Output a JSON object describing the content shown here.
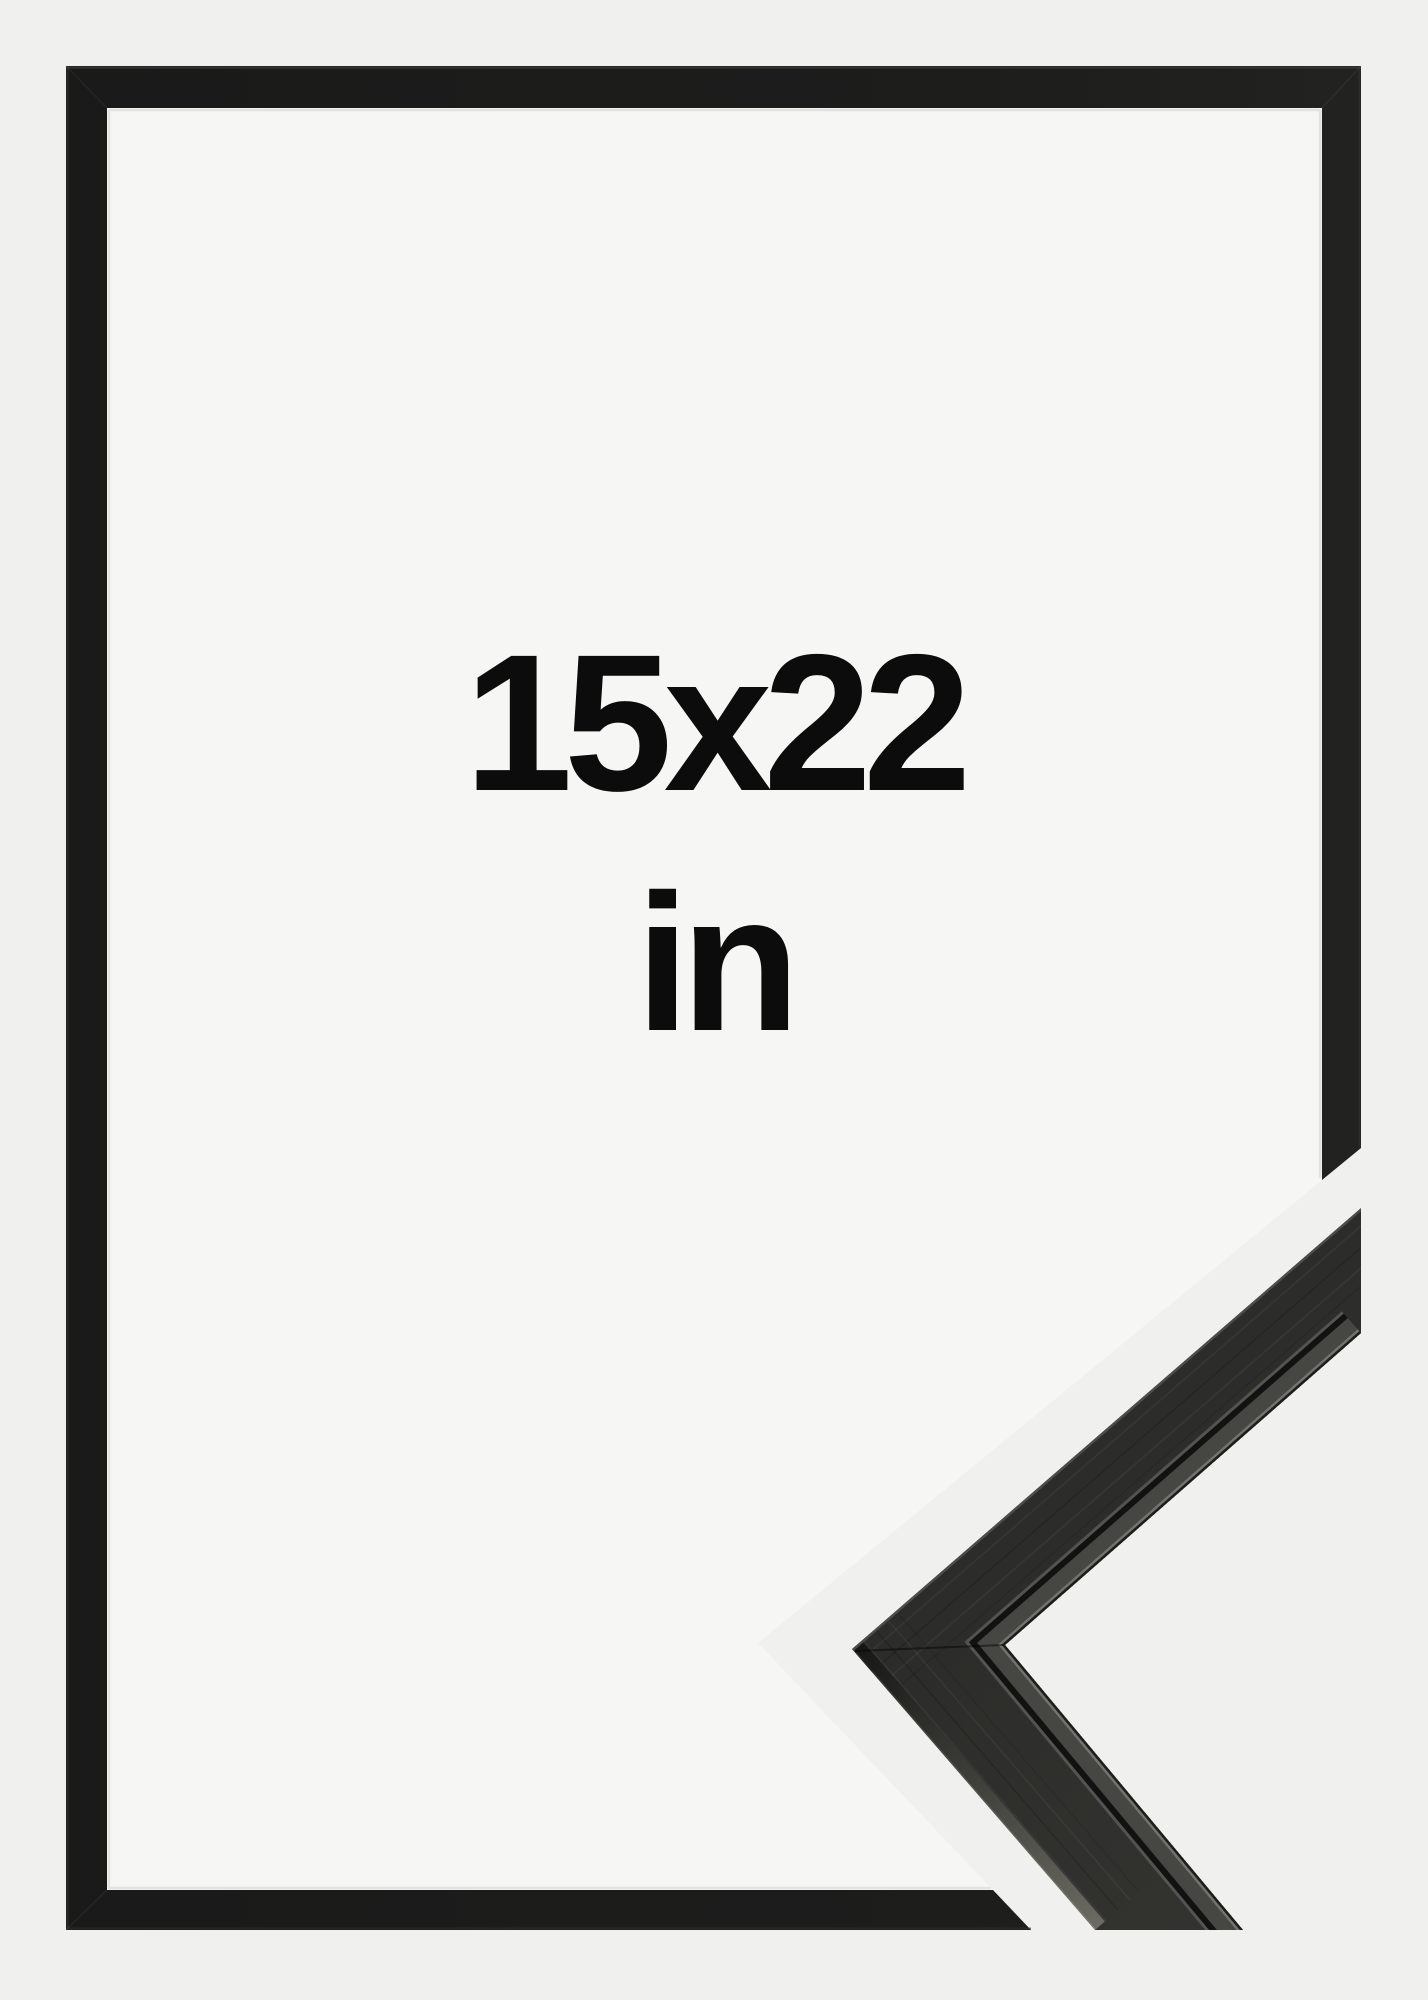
{
  "product_image": {
    "alt": "Empty black picture frame product photo with corner moulding close-up",
    "size_label": "15x22",
    "unit_label": "in"
  },
  "colors": {
    "page_background": "#f0f0ee",
    "mat_interior": "#f6f6f5",
    "frame_black": "#1b1b1b",
    "moulding_face_dark": "#2a2a28",
    "moulding_face_light": "#343431",
    "moulding_lip": "#464642",
    "label_text": "#0c0c0c"
  }
}
